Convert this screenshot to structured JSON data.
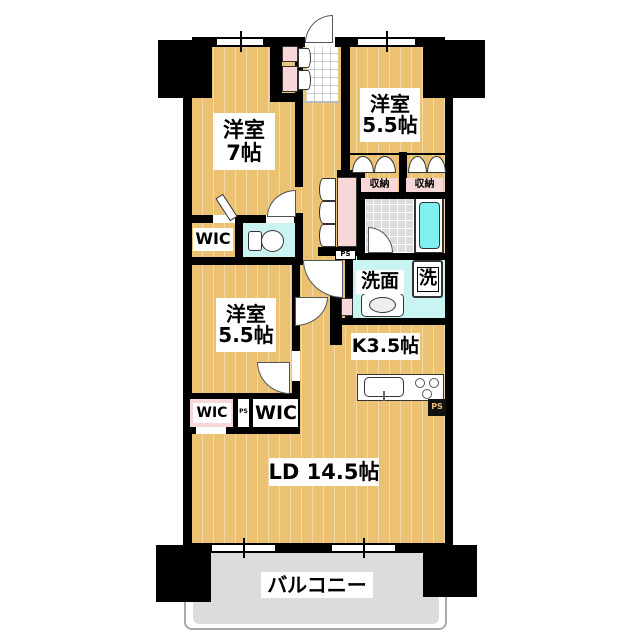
{
  "plan_type": "apartment-floor-plan",
  "colors": {
    "floor_wood": "#EAC271",
    "closet_pink": "#F8D7D8",
    "water_area": "#C9F4F2",
    "bathtub": "#7FEFEF",
    "balcony_gray": "#DCDCDC",
    "bath_tile": "#D9DDDD",
    "wall": "#000000"
  },
  "rooms": {
    "bedroom7": {
      "name": "洋室",
      "size": "7帖"
    },
    "bedroom55_top": {
      "name": "洋室",
      "size": "5.5帖"
    },
    "bedroom55_mid": {
      "name": "洋室",
      "size": "5.5帖"
    },
    "kitchen": {
      "label": "K3.5帖"
    },
    "living_dining": {
      "label": "LD 14.5帖"
    },
    "washroom": {
      "label": "洗面"
    },
    "washer": {
      "label": "洗"
    },
    "balcony": {
      "label": "バルコニー"
    }
  },
  "closets": {
    "wic_upper": "WIC",
    "wic_lower_left": "WIC",
    "wic_lower_right": "WIC",
    "storage_left": "収納",
    "storage_right": "収納"
  },
  "shafts": {
    "ps_corridor": "PS",
    "ps_lower": "PS",
    "ps_kitchen": "PS"
  }
}
